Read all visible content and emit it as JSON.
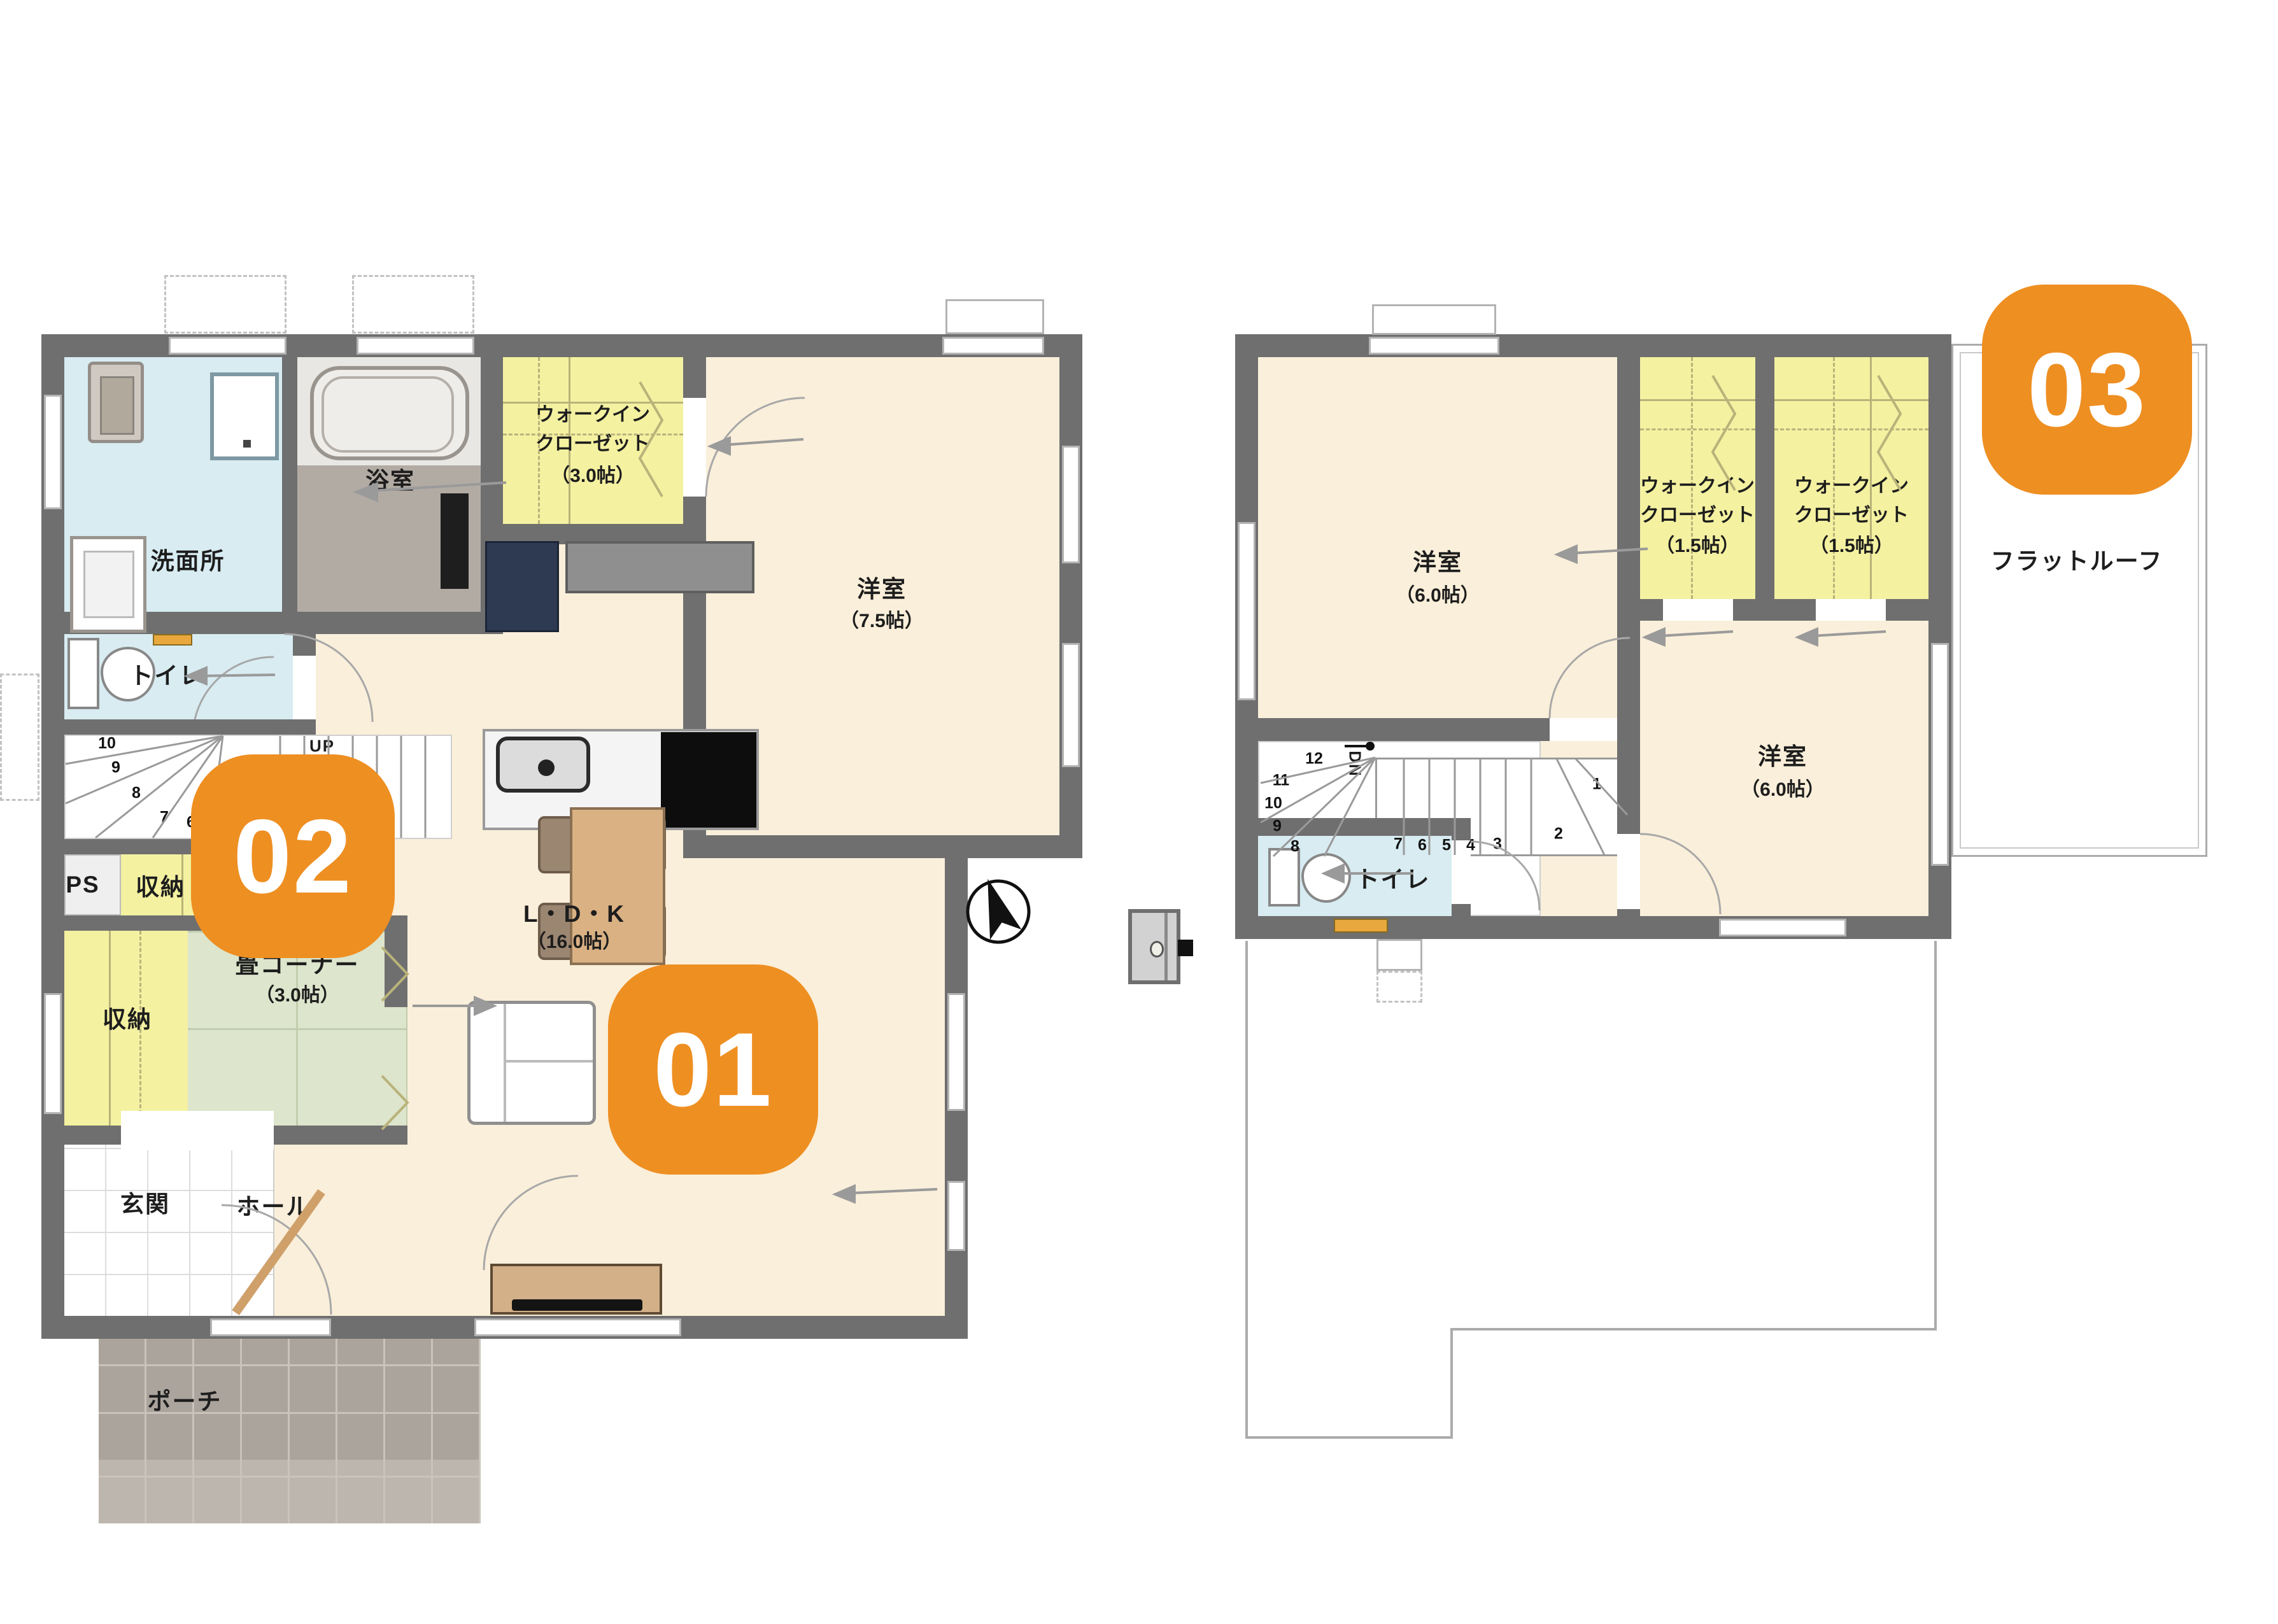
{
  "palette": {
    "badge_orange": "#EE8F22",
    "wall_gray": "#6F6F6F"
  },
  "badges": {
    "b01": "01",
    "b02": "02",
    "b03": "03"
  },
  "floor1": {
    "washroom": "洗面所",
    "bath": "浴室",
    "wic": {
      "l1": "ウォークイン",
      "l2": "クローゼット",
      "size": "（3.0帖）"
    },
    "bedroom": {
      "name": "洋室",
      "size": "（7.5帖）"
    },
    "toilet": "トイレ",
    "up": "UP",
    "stairs": {
      "s10": "10",
      "s9": "9",
      "s8": "8",
      "s7": "7",
      "s6": "6"
    },
    "ps": "PS",
    "storage_a": "収納",
    "storage_b": "収納",
    "tatami": {
      "name": "畳コーナー",
      "size": "（3.0帖）"
    },
    "ldk": {
      "name": "L・D・K",
      "size": "（16.0帖）"
    },
    "entrance": "玄関",
    "hall": "ホール",
    "porch": "ポーチ"
  },
  "floor2": {
    "bedroom_a": {
      "name": "洋室",
      "size": "（6.0帖）"
    },
    "wic1": {
      "l1": "ウォークイン",
      "l2": "クローゼット",
      "size": "（1.5帖）"
    },
    "wic2": {
      "l1": "ウォークイン",
      "l2": "クローゼット",
      "size": "（1.5帖）"
    },
    "bedroom_b": {
      "name": "洋室",
      "size": "（6.0帖）"
    },
    "toilet": "トイレ",
    "dn": "DN",
    "flat_roof": "フラットルーフ",
    "stairs": {
      "s12": "12",
      "s11": "11",
      "s10": "10",
      "s9": "9",
      "s8": "8",
      "s7": "7",
      "s6": "6",
      "s5": "5",
      "s4": "4",
      "s3": "3",
      "s2": "2",
      "s1": "1"
    }
  }
}
